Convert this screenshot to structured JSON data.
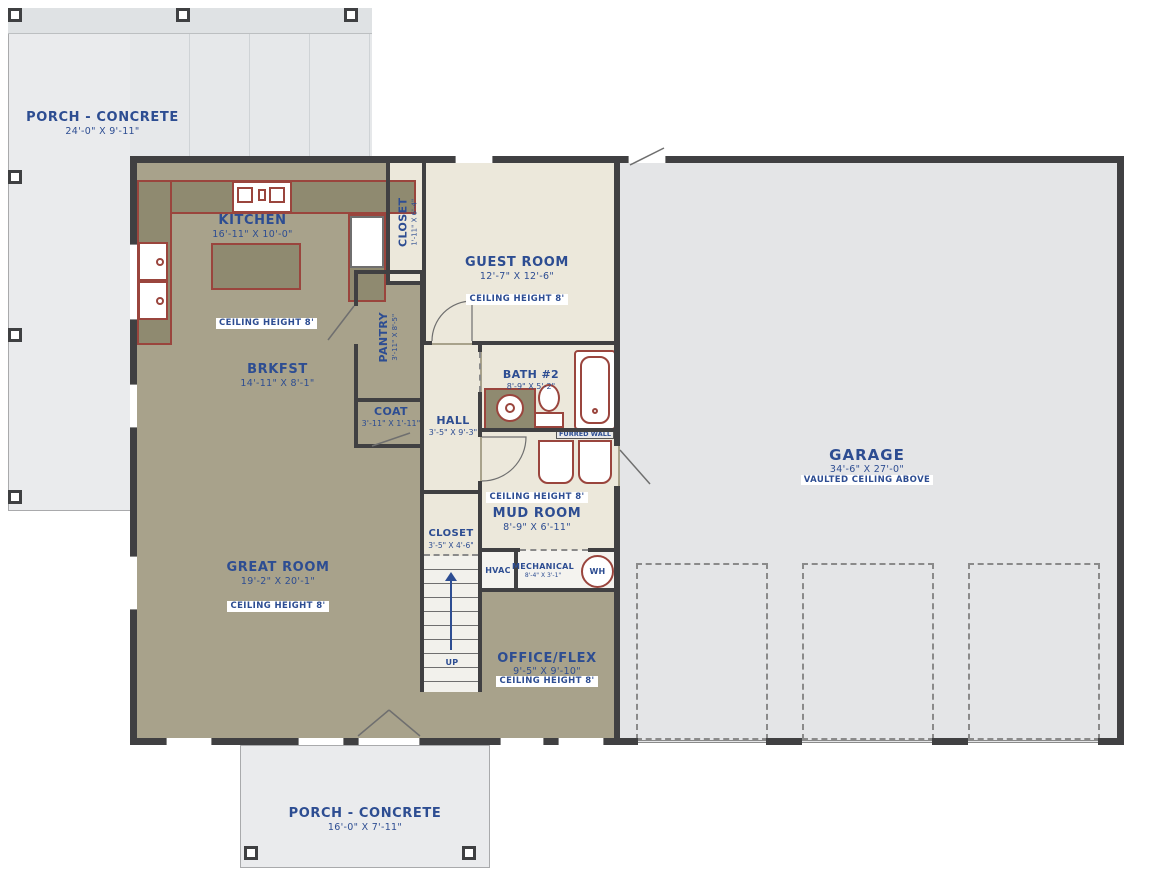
{
  "meta": {
    "title": "First Floor Plan"
  },
  "colors": {
    "floor_tan": "#a8a28b",
    "floor_olive": "#8f8a70",
    "floor_cream": "#ece8db",
    "floor_garage": "#e4e5e7",
    "porch": "#eaebed",
    "wall": "#404042",
    "fixture_outline": "#9a453d",
    "text_navy": "#2d4d92"
  },
  "rooms": {
    "porch_top": {
      "name": "PORCH - CONCRETE",
      "dims": "24'-0\" X 9'-11\""
    },
    "porch_bottom": {
      "name": "PORCH - CONCRETE",
      "dims": "16'-0\" X 7'-11\""
    },
    "kitchen": {
      "name": "KITCHEN",
      "dims": "16'-11\" X 10'-0\"",
      "ceiling": "CEILING HEIGHT 8'"
    },
    "closet_top": {
      "name": "CLOSET",
      "dims": "1'-11\" X 6'-4\""
    },
    "guest_room": {
      "name": "GUEST ROOM",
      "dims": "12'-7\" X 12'-6\"",
      "ceiling": "CEILING HEIGHT 8'"
    },
    "pantry": {
      "name": "PANTRY",
      "dims": "3'-11\" X 8'-5\""
    },
    "brkfst": {
      "name": "BRKFST",
      "dims": "14'-11\" X 8'-1\""
    },
    "bath2": {
      "name": "BATH #2",
      "dims": "8'-9\" X 5'-2\""
    },
    "coat": {
      "name": "COAT",
      "dims": "3'-11\" X 1'-11\""
    },
    "hall": {
      "name": "HALL",
      "dims": "3'-5\" X 9'-3\""
    },
    "great_room": {
      "name": "GREAT ROOM",
      "dims": "19'-2\" X 20'-1\"",
      "ceiling": "CEILING HEIGHT 8'"
    },
    "mud_room": {
      "name": "MUD ROOM",
      "dims": "8'-9\" X 6'-11\"",
      "ceiling": "CEILING HEIGHT 8'"
    },
    "closet_stairs": {
      "name": "CLOSET",
      "dims": "3'-5\" X 4'-6\""
    },
    "hvac": {
      "name": "HVAC"
    },
    "mechanical": {
      "name": "MECHANICAL",
      "dims": "8'-4\" X 3'-1\""
    },
    "water_heater": {
      "name": "WH"
    },
    "office": {
      "name": "OFFICE/FLEX",
      "dims": "9'-5\" X 9'-10\"",
      "ceiling": "CEILING HEIGHT 8'"
    },
    "garage": {
      "name": "GARAGE",
      "dims": "34'-6\" X 27'-0\"",
      "note": "VAULTED CEILING ABOVE"
    }
  },
  "annotations": {
    "stairs_up": "UP",
    "furred_wall": "FURRED WALL"
  }
}
